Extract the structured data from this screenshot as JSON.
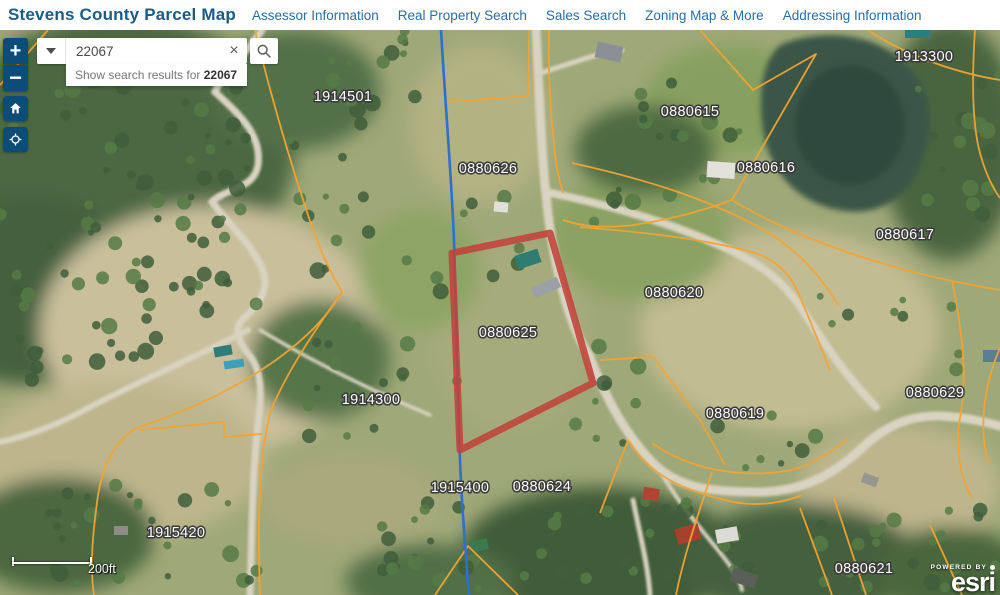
{
  "header": {
    "title": "Stevens County Parcel Map",
    "nav": [
      {
        "label": "Assessor Information"
      },
      {
        "label": "Real Property Search"
      },
      {
        "label": "Sales Search"
      },
      {
        "label": "Zoning Map & More"
      },
      {
        "label": "Addressing Information"
      }
    ]
  },
  "search": {
    "value": "22067",
    "suggestion_prefix": "Show search results for ",
    "suggestion_term": "22067",
    "clear_icon": "×"
  },
  "map_controls": {
    "zoom_in": "+",
    "zoom_out": "−"
  },
  "scale_bar": {
    "label": "200ft"
  },
  "attribution": {
    "powered_by": "POWERED BY",
    "brand": "esri"
  },
  "map": {
    "selected_parcel": "0880625",
    "parcel_labels": [
      {
        "text": "1914501",
        "x": 343,
        "y": 71
      },
      {
        "text": "1913300",
        "x": 924,
        "y": 31
      },
      {
        "text": "0880615",
        "x": 690,
        "y": 86
      },
      {
        "text": "0880626",
        "x": 488,
        "y": 143
      },
      {
        "text": "0880616",
        "x": 766,
        "y": 142
      },
      {
        "text": "0880617",
        "x": 905,
        "y": 209
      },
      {
        "text": "0880620",
        "x": 674,
        "y": 267
      },
      {
        "text": "0880625",
        "x": 508,
        "y": 307
      },
      {
        "text": "0880629",
        "x": 935,
        "y": 367
      },
      {
        "text": "1914300",
        "x": 371,
        "y": 374
      },
      {
        "text": "0880619",
        "x": 735,
        "y": 388
      },
      {
        "text": "1915400",
        "x": 460,
        "y": 462
      },
      {
        "text": "0880624",
        "x": 542,
        "y": 461
      },
      {
        "text": "1915420",
        "x": 176,
        "y": 507
      },
      {
        "text": "0880621",
        "x": 864,
        "y": 543
      }
    ],
    "colors": {
      "parcel_line": "#f2a433",
      "selected_outline": "#c2423a",
      "boundary_line": "#2e6fd0",
      "control_blue": "#0c4c78"
    }
  }
}
